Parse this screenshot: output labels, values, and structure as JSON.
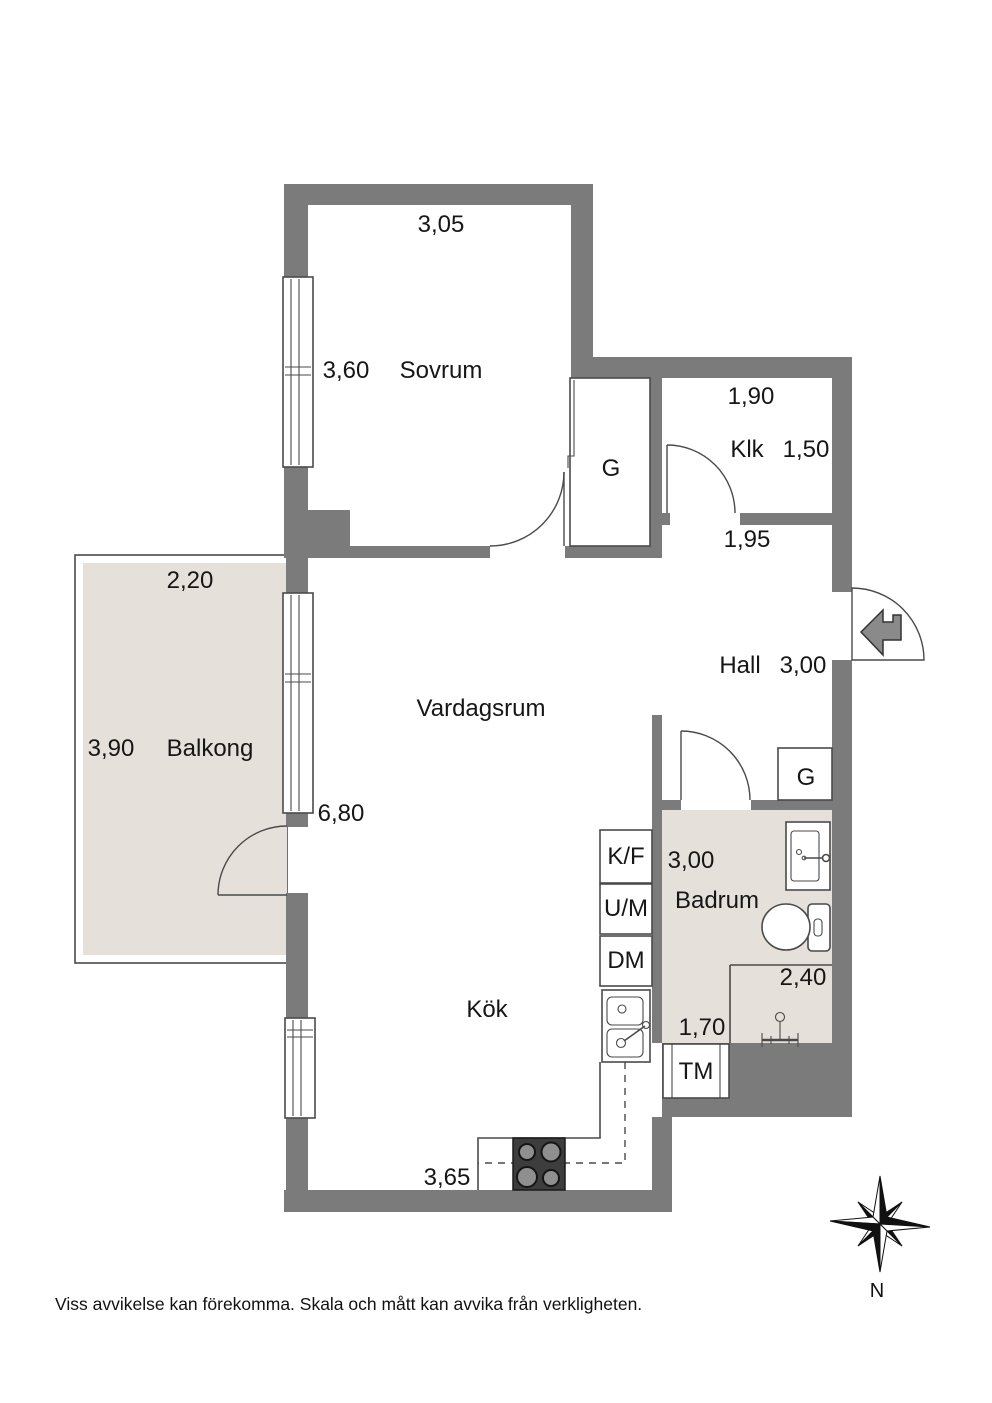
{
  "colors": {
    "wall": "#7b7b7b",
    "floor_accent": "#e5e1da",
    "line": "#4a4a4a"
  },
  "labels": {
    "sovrum": "Sovrum",
    "klk": "Klk",
    "hall": "Hall",
    "vardagsrum": "Vardagsrum",
    "balkong": "Balkong",
    "kok": "Kök",
    "badrum": "Badrum",
    "dim_sovrum_w": "3,05",
    "dim_sovrum_h": "3,60",
    "dim_klk_w": "1,90",
    "dim_klk_h": "1,50",
    "dim_hall_top": "1,95",
    "dim_hall_w": "3,00",
    "dim_balkong_w": "2,20",
    "dim_balkong_h": "3,90",
    "dim_window": "6,80",
    "dim_badrum_h": "3,00",
    "dim_shower": "2,40",
    "dim_badrum_w": "1,70",
    "dim_kok_w": "3,65",
    "wardrobe": "G",
    "fridge_freezer": "K/F",
    "oven_micro": "U/M",
    "dishwasher": "DM",
    "washing_machine": "TM",
    "north": "N",
    "disclaimer": "Viss avvikelse kan förekomma. Skala och mått kan avvika från verkligheten."
  }
}
